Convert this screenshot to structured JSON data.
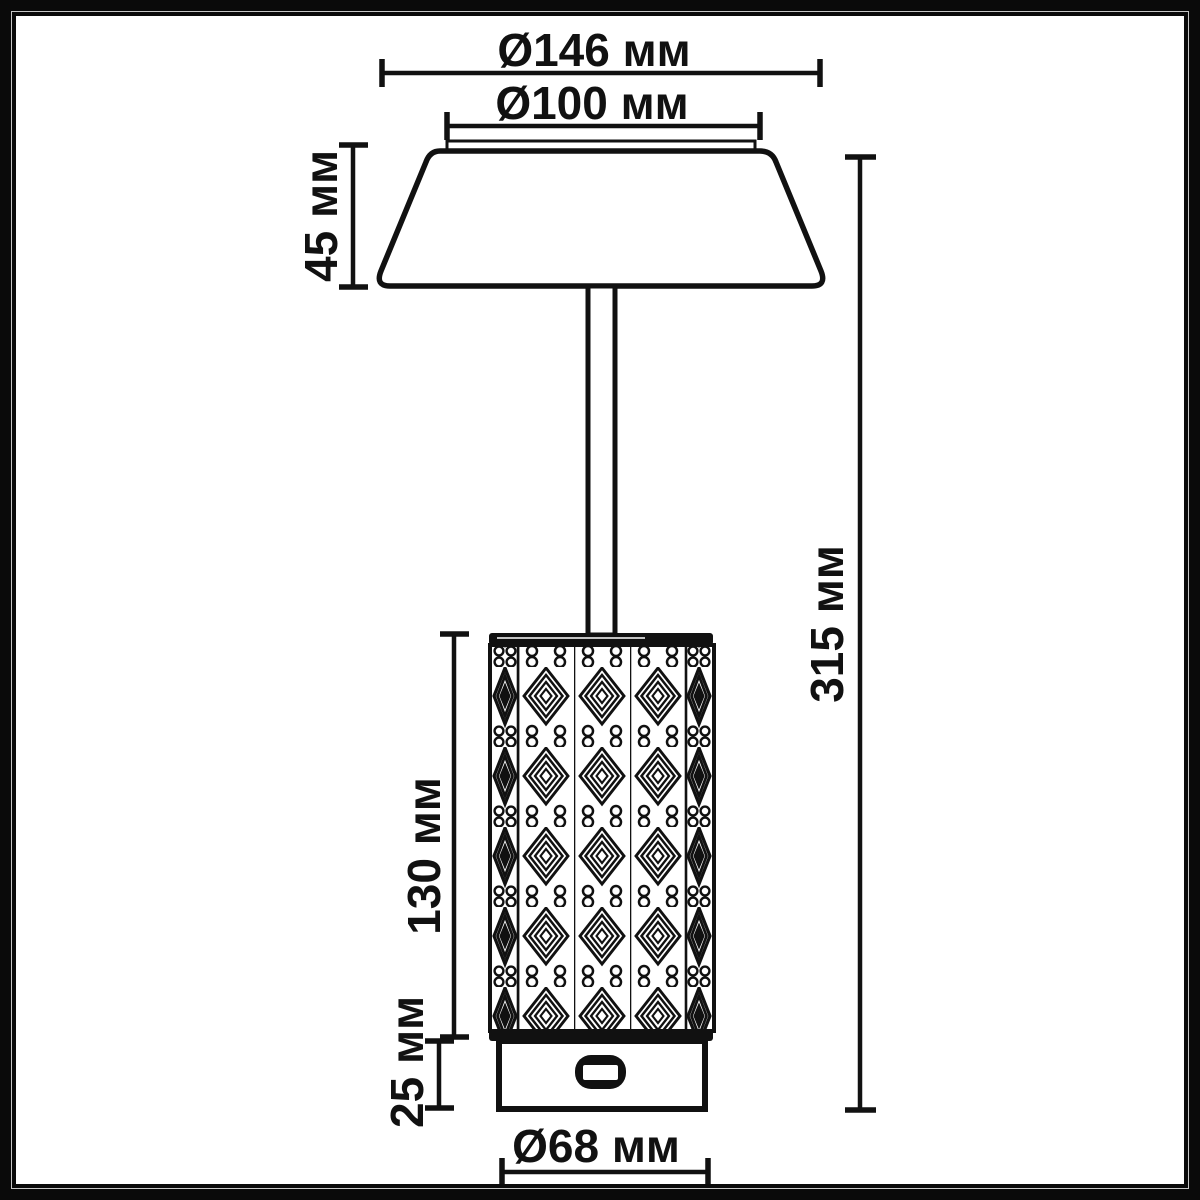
{
  "diagram": {
    "subject": "table-lamp-dimension-drawing",
    "unit": "мм",
    "labels": {
      "shade_outer_diameter": "Ø146 мм",
      "shade_inner_diameter": "Ø100 мм",
      "shade_height": "45 мм",
      "total_height": "315 мм",
      "body_height": "130 мм",
      "base_height": "25 мм",
      "base_diameter": "Ø68 мм"
    },
    "dimensions": [
      {
        "name": "shade outer diameter",
        "value": 146,
        "unit": "мм"
      },
      {
        "name": "shade inner diameter",
        "value": 100,
        "unit": "мм"
      },
      {
        "name": "shade height",
        "value": 45,
        "unit": "мм"
      },
      {
        "name": "total height",
        "value": 315,
        "unit": "мм"
      },
      {
        "name": "body height",
        "value": 130,
        "unit": "мм"
      },
      {
        "name": "base height",
        "value": 25,
        "unit": "мм"
      },
      {
        "name": "base diameter",
        "value": 68,
        "unit": "мм"
      }
    ],
    "colors": {
      "line": "#111111",
      "background": "#ffffff",
      "frame": "#0a0a0a"
    }
  }
}
